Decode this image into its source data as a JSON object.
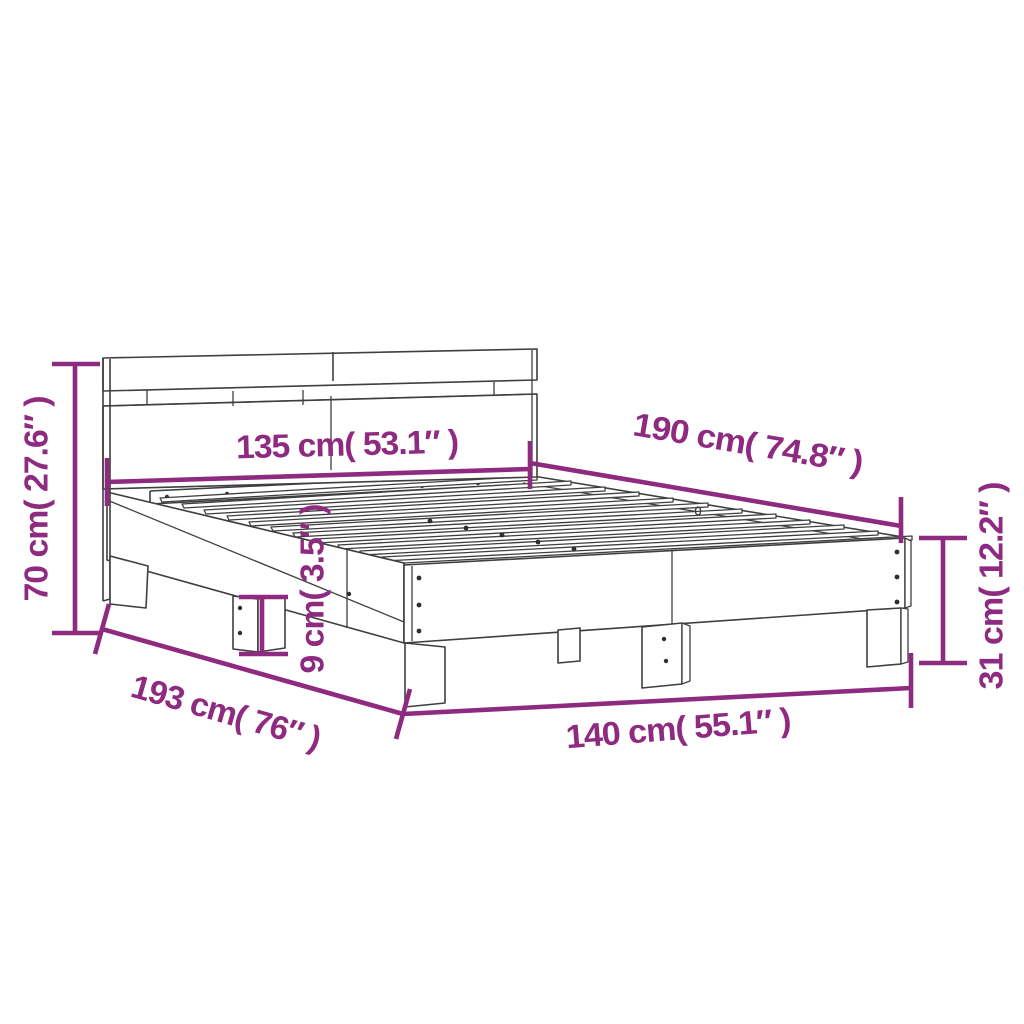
{
  "diagram": {
    "title": "bed-frame-with-headboard-dimension-diagram",
    "accent_color": "#8E2A80",
    "line_color": "#3f3f3f",
    "background_color": "#ffffff",
    "dimensions": {
      "headboard_height": "70 cm( 27.6″ )",
      "headboard_width": "135 cm( 53.1″ )",
      "bed_length": "190 cm( 74.8″ )",
      "frame_side_height": "31 cm( 12.2″ )",
      "leg_height": "9 cm( 3.5″ )",
      "total_length": "193 cm( 76″ )",
      "frame_width": "140 cm( 55.1″ )"
    }
  }
}
